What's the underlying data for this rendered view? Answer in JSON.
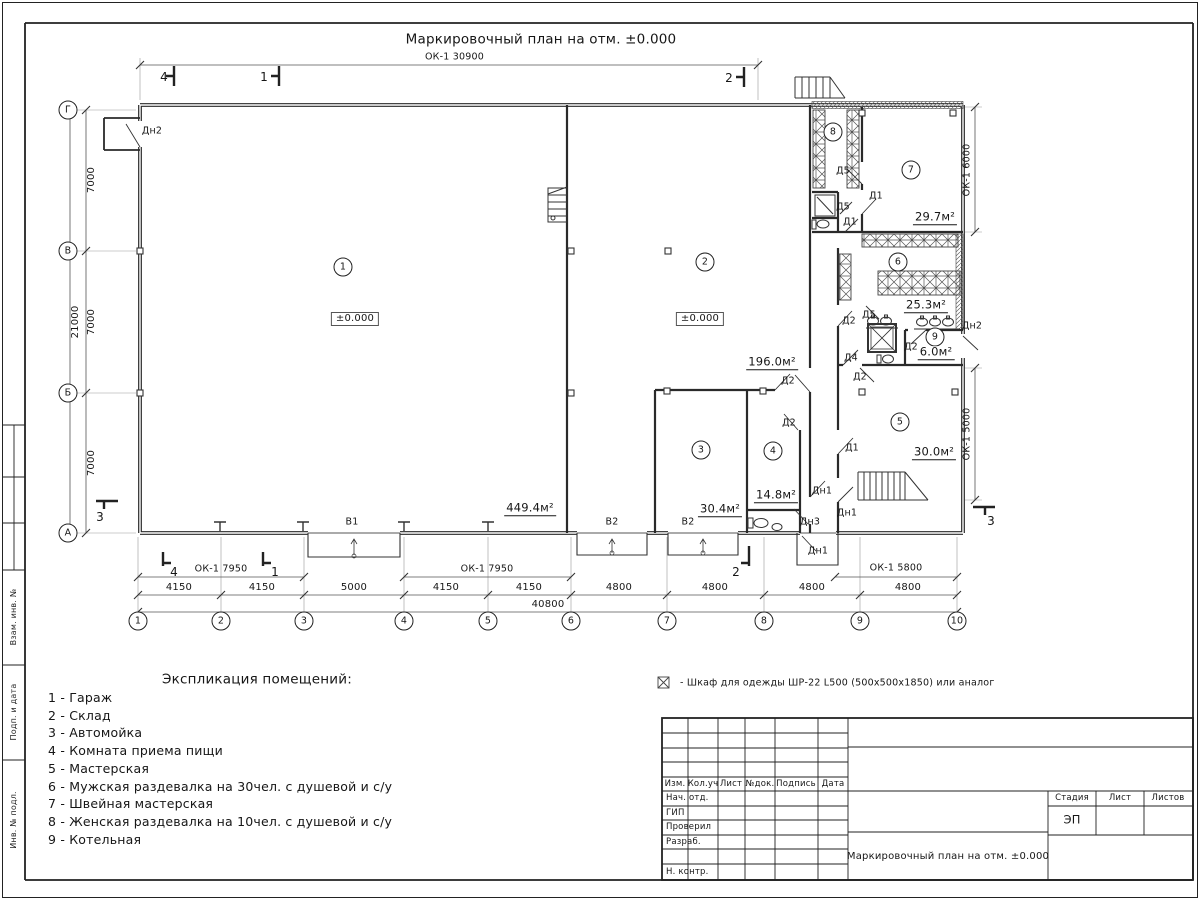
{
  "colors": {
    "ink": "#1f1f1f",
    "paper": "#ffffff"
  },
  "title": "Маркировочный план на отм. ±0.000",
  "plan": {
    "windows": {
      "top": "ОК-1 30900",
      "bl": "ОК-1 7950",
      "bm": "ОК-1 7950",
      "br": "ОК-1 5800",
      "ru": "ОК-1 6000",
      "rl": "ОК-1 5000"
    },
    "rooms": {
      "r1": {
        "num": "1",
        "elev": "±0.000",
        "area": "449.4м²"
      },
      "r2": {
        "num": "2",
        "elev": "±0.000",
        "area": "196.0м²"
      },
      "r3": {
        "num": "3",
        "area": "30.4м²"
      },
      "r4": {
        "num": "4",
        "area": "14.8м²"
      },
      "r5": {
        "num": "5",
        "area": "30.0м²"
      },
      "r6": {
        "num": "6",
        "area": "25.3м²"
      },
      "r7": {
        "num": "7",
        "area": "29.7м²"
      },
      "r8": {
        "num": "8"
      },
      "r9": {
        "num": "9",
        "area": "6.0м²"
      }
    },
    "doors": {
      "dn1": "Дн1",
      "dn2": "Дн2",
      "dn3": "Дн3",
      "d1": "Д1",
      "d2": "Д2",
      "d4": "Д4",
      "d5": "Д5"
    },
    "gates": {
      "v1": "В1",
      "v2": "В2"
    },
    "dims": {
      "segments": [
        "4150",
        "4150",
        "5000",
        "4150",
        "4150",
        "4800",
        "4800",
        "4800",
        "4800"
      ],
      "total": "40800",
      "left": [
        "7000",
        "7000",
        "7000"
      ],
      "left_total": "21000"
    },
    "axes": {
      "bottom": [
        "1",
        "2",
        "3",
        "4",
        "5",
        "6",
        "7",
        "8",
        "9",
        "10"
      ],
      "left": [
        "Г",
        "В",
        "Б",
        "А"
      ]
    },
    "sections": {
      "s1": "1",
      "s2": "2",
      "s3": "3",
      "s4": "4"
    }
  },
  "legend": {
    "title": "Экспликация помещений:",
    "items": [
      "1 - Гараж",
      "2 - Склад",
      "3 - Автомойка",
      "4 - Комната приема пищи",
      "5 - Мастерская",
      "6 - Мужская раздевалка на 30чел. с душевой и с/у",
      "7 - Швейная мастерская",
      "8 - Женская раздевалка на 10чел. с душевой и с/у",
      "9 - Котельная"
    ]
  },
  "note": "- Шкаф для одежды ШР-22 L500 (500х500х1850) или аналог",
  "titleblock": {
    "rev": [
      "Изм.",
      "Кол.уч",
      "Лист",
      "№док.",
      "Подпись",
      "Дата"
    ],
    "sign": [
      "Нач. отд.",
      "ГИП",
      "Проверил",
      "Разраб.",
      "Н. контр."
    ],
    "doc": "Маркировочный план на отм. ±0.000",
    "stage_h": "Стадия",
    "sheet_h": "Лист",
    "sheets_h": "Листов",
    "stage": "ЭП"
  },
  "frame": {
    "side": [
      "Взам. инв. №",
      "Подп. и дата",
      "Инв. № подл."
    ]
  }
}
